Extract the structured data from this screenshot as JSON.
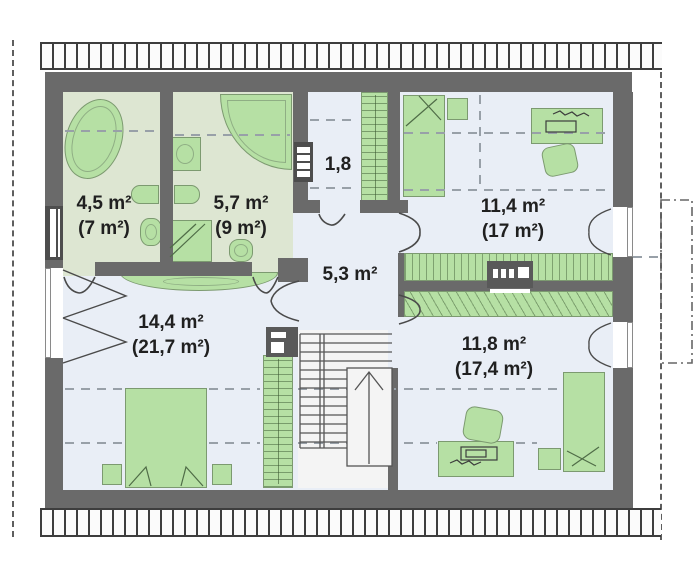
{
  "plan": {
    "type": "floor-plan",
    "floor": "attic-storey",
    "rooms": [
      {
        "id": "bathroom-small",
        "area": "4,5 m²",
        "area_total": "(7 m²)"
      },
      {
        "id": "bathroom-large",
        "area": "5,7 m²",
        "area_total": "(9 m²)"
      },
      {
        "id": "landing",
        "area": "1,8",
        "area_total": ""
      },
      {
        "id": "bedroom-top-right",
        "area": "11,4 m²",
        "area_total": "(17 m²)"
      },
      {
        "id": "hall",
        "area": "5,3 m²",
        "area_total": ""
      },
      {
        "id": "bedroom-master",
        "area": "14,4 m²",
        "area_total": "(21,7 m²)"
      },
      {
        "id": "bedroom-bottom-right",
        "area": "11,8 m²",
        "area_total": "(17,4 m²)"
      }
    ],
    "colors": {
      "wall": "#6a6a6a",
      "bathroom_floor": "#dde6d2",
      "room_floor": "#e9eef6",
      "furniture": "#b6e0a4",
      "furniture_outline": "#7c9a70",
      "text": "#202020"
    }
  }
}
